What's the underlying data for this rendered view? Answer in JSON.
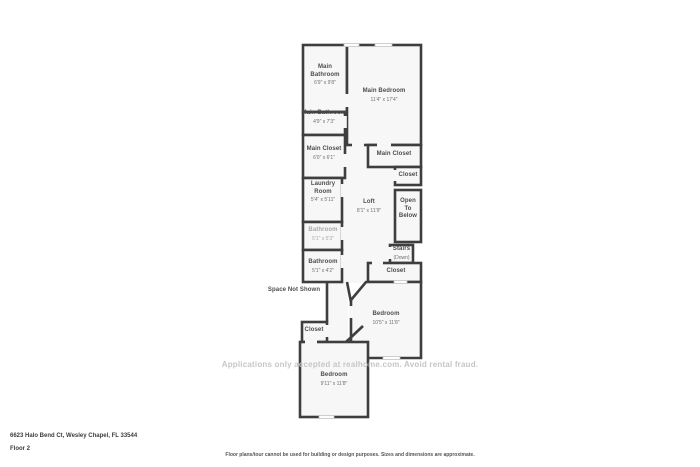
{
  "page": {
    "address": "6623 Halo Bend Ct, Wesley Chapel, FL 33544",
    "floor_label": "Floor 2",
    "disclaimer": "Floor plans/tour cannot be used for building or design purposes. Sizes and dimensions are approximate.",
    "watermark": "Applications only accepted at realhome.com. Avoid rental fraud."
  },
  "colors": {
    "wall": "#3e3e3e",
    "room_fill": "#f7f7f7",
    "background": "#ffffff",
    "room_label": "#4c4c4c",
    "dimension_label": "#6f6f6f",
    "faded_label": "#a8a8a8",
    "watermark_text": "#c6c6c6"
  },
  "rooms": {
    "main_bathroom_upper": {
      "name": "Main Bathroom",
      "dims": "6'9\" x 9'8\""
    },
    "main_bedroom": {
      "name": "Main Bedroom",
      "dims": "11'4\" x 17'4\""
    },
    "main_bathroom_lower": {
      "name": "Main Bathroom",
      "dims": "4'9\" x 7'3\""
    },
    "main_closet_left": {
      "name": "Main Closet",
      "dims": "6'0\" x 6'1\""
    },
    "main_closet_right": {
      "name": "Main Closet"
    },
    "closet_upper_right": {
      "name": "Closet"
    },
    "laundry": {
      "name": "Laundry Room",
      "dims": "5'4\" x 5'11\""
    },
    "loft": {
      "name": "Loft",
      "dims": "8'1\" x 11'9\""
    },
    "open_to_below": {
      "name": "Open To Below"
    },
    "bathroom_upper": {
      "name": "Bathroom",
      "dims": "5'1\" x 5'3\""
    },
    "bathroom_lower": {
      "name": "Bathroom",
      "dims": "5'1\" x 4'2\""
    },
    "stairs": {
      "name": "Stairs",
      "sub": "(Down)"
    },
    "closet_mid_right": {
      "name": "Closet"
    },
    "space_not_shown": {
      "name": "Space Not Shown"
    },
    "bedroom_mid": {
      "name": "Bedroom",
      "dims": "10'5\" x 11'8\""
    },
    "closet_small": {
      "name": "Closet"
    },
    "bedroom_bottom": {
      "name": "Bedroom",
      "dims": "9'11\" x 11'8\""
    }
  }
}
